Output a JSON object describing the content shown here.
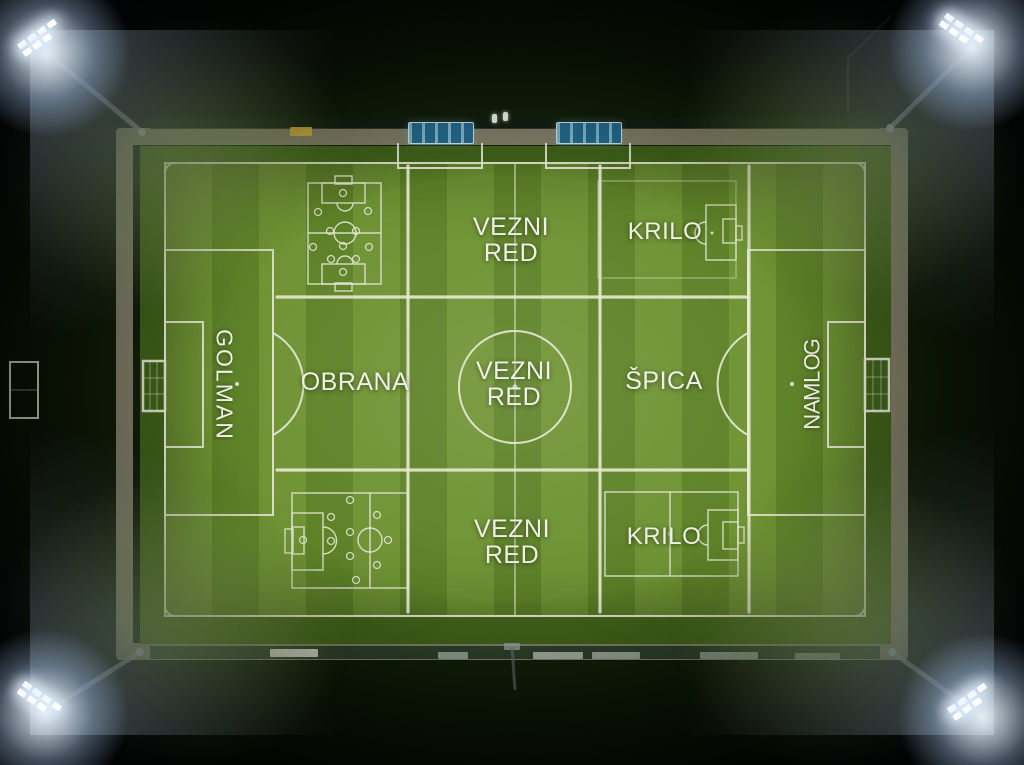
{
  "labels": {
    "goalkeeper_left": "GOLMAN",
    "goalkeeper_right": "GOLMAN",
    "defense": "OBRANA",
    "midfield_top": {
      "line1": "VEZNI",
      "line2": "RED"
    },
    "midfield_center": {
      "line1": "VEZNI",
      "line2": "RED"
    },
    "midfield_bottom": {
      "line1": "VEZNI",
      "line2": "RED"
    },
    "striker": "ŠPICA",
    "wing_top": "KRILO",
    "wing_bottom": "KRILO"
  },
  "colors": {
    "background": "#020302",
    "pitch_stripe_light": "#6e9233",
    "pitch_stripe_dark": "#5d8127",
    "line_white": "#e6e8d5",
    "chalk_white": "#ecedd9",
    "label_text": "#eef0e3",
    "track_grey": "#8f8a74",
    "dugout_blue": "#236a8e",
    "floodlight_glow": "#dceaff"
  }
}
